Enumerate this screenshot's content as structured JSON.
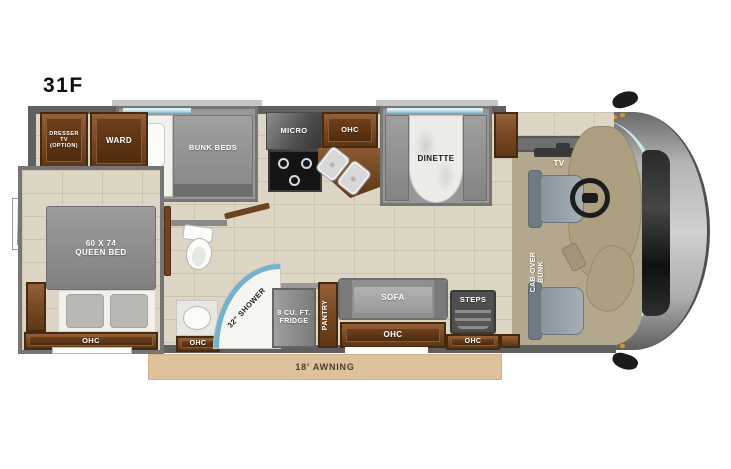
{
  "title": "31F",
  "colors": {
    "floor_tile": "#ddd6c5",
    "wall_gray": "#5f5f5f",
    "slide_wall": "#989898",
    "cabinet_wood": "#7a4b25",
    "furniture_gray": "#8d8d8d",
    "window_blue": "#5da6c6",
    "awning_tan": "#dfc19b",
    "cab_floor_beige": "#b3a88d",
    "marble": "#edece8"
  },
  "labels": {
    "dresser_line1": "DRESSER",
    "dresser_line2": "TV (OPTION)",
    "ward": "WARD",
    "bunk_beds": "BUNK BEDS",
    "micro": "MICRO",
    "kitchen_ohc": "OHC",
    "dinette": "DINETTE",
    "tv": "TV",
    "cab_over_bunk_line1": "CAB-OVER",
    "cab_over_bunk_line2": "BUNK",
    "queen_bed_line1": "60 X 74",
    "queen_bed_line2": "QUEEN BED",
    "bed_ohc": "OHC",
    "bath_ohc": "OHC",
    "shower": "32\" SHOWER",
    "fridge_line1": "8 CU. FT.",
    "fridge_line2": "FRIDGE",
    "pantry": "PANTRY",
    "sofa": "SOFA",
    "sofa_ohc": "OHC",
    "steps": "STEPS",
    "entry_ohc": "OHC",
    "awning": "18' AWNING"
  }
}
